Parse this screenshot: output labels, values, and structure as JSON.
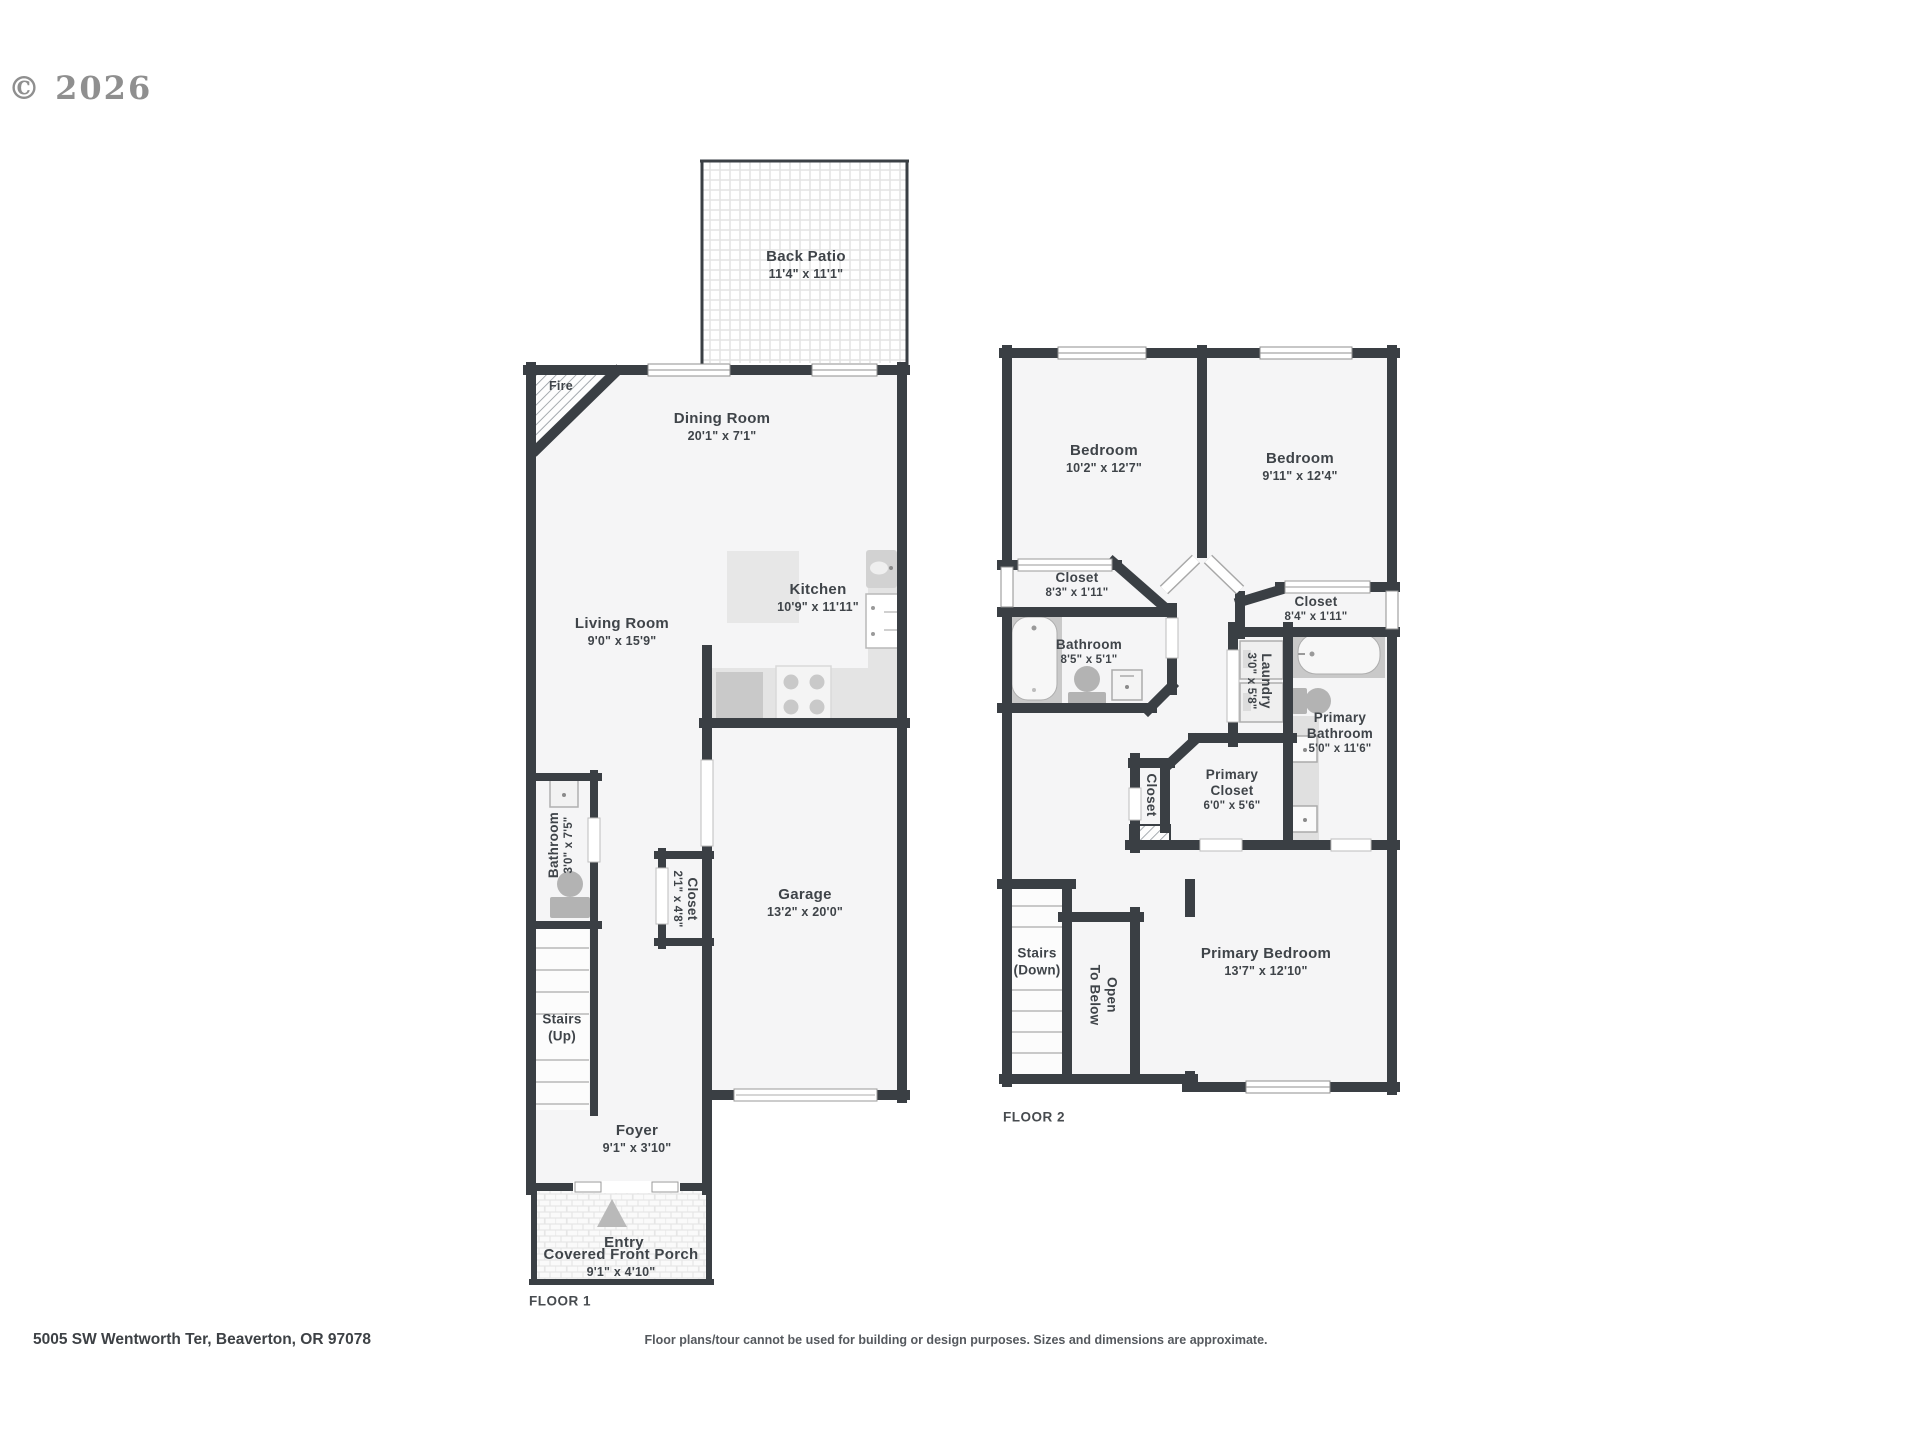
{
  "meta": {
    "copyright": "© 2026",
    "address": "5005 SW Wentworth Ter, Beaverton, OR 97078",
    "disclaimer": "Floor plans/tour cannot be used for building or design purposes. Sizes and dimensions are approximate."
  },
  "colors": {
    "wall": "#3a3f44",
    "text": "#3f4449",
    "fixture": "#b3b3b3",
    "counter": "#e4e4e4",
    "floor": "#f5f5f6"
  },
  "floor1": {
    "label": "FLOOR 1",
    "rooms": {
      "back_patio": {
        "name": "Back Patio",
        "dims": "11'4\" x 11'1\""
      },
      "dining": {
        "name": "Dining Room",
        "dims": "20'1\" x 7'1\""
      },
      "living": {
        "name": "Living Room",
        "dims": "9'0\" x 15'9\""
      },
      "kitchen": {
        "name": "Kitchen",
        "dims": "10'9\" x 11'11\""
      },
      "fire": {
        "name": "Fire"
      },
      "bathroom": {
        "name": "Bathroom",
        "dims": "3'0\" x 7'5\""
      },
      "closet": {
        "name": "Closet",
        "dims": "2'1\" x 4'8\""
      },
      "stairs": {
        "name": "Stairs",
        "dims": "(Up)"
      },
      "garage": {
        "name": "Garage",
        "dims": "13'2\" x 20'0\""
      },
      "foyer": {
        "name": "Foyer",
        "dims": "9'1\" x 3'10\""
      },
      "entry": {
        "name": "Entry"
      },
      "porch": {
        "name": "Covered Front Porch",
        "dims": "9'1\" x 4'10\""
      }
    }
  },
  "floor2": {
    "label": "FLOOR 2",
    "rooms": {
      "bedroom_left": {
        "name": "Bedroom",
        "dims": "10'2\" x 12'7\""
      },
      "bedroom_right": {
        "name": "Bedroom",
        "dims": "9'11\" x 12'4\""
      },
      "closet_left": {
        "name": "Closet",
        "dims": "8'3\" x 1'11\""
      },
      "closet_right": {
        "name": "Closet",
        "dims": "8'4\" x 1'11\""
      },
      "bathroom": {
        "name": "Bathroom",
        "dims": "8'5\" x 5'1\""
      },
      "laundry": {
        "name": "Laundry",
        "dims": "3'0\" x 5'8\""
      },
      "primary_bathroom": {
        "name": "Primary Bathroom",
        "dims": "5'0\" x 11'6\""
      },
      "primary_closet": {
        "name": "Primary Closet",
        "dims": "6'0\" x 5'6\""
      },
      "closet_small": {
        "name": "Closet"
      },
      "stairs": {
        "name": "Stairs",
        "dims": "(Down)"
      },
      "open_below": {
        "name": "Open",
        "dims": "To Below"
      },
      "primary_bedroom": {
        "name": "Primary Bedroom",
        "dims": "13'7\" x 12'10\""
      }
    }
  }
}
